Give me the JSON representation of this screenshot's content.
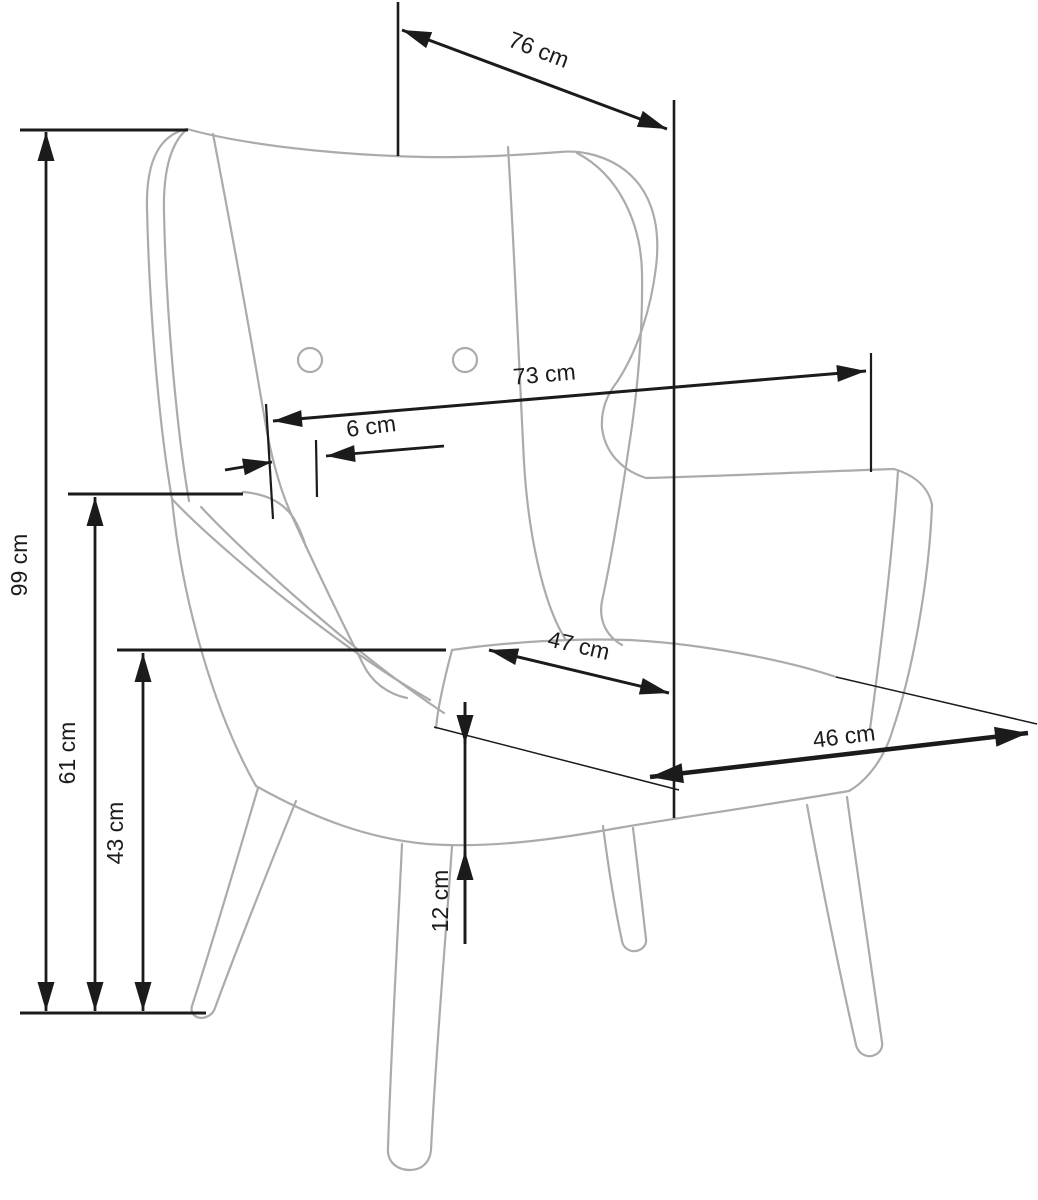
{
  "drawing": {
    "subject": "wingback armchair dimension drawing",
    "unit": "cm",
    "background_color": "#ffffff",
    "outline_color": "#ababab",
    "dimension_color": "#1b1b1b",
    "button_count": 2
  },
  "dims": {
    "top_depth": {
      "label": "76 cm",
      "value": 76,
      "unit": "cm",
      "orientation": "diagonal"
    },
    "total_depth": {
      "label": "73 cm",
      "value": 73,
      "unit": "cm",
      "orientation": "horizontal"
    },
    "back_offset": {
      "label": "6 cm",
      "value": 6,
      "unit": "cm",
      "orientation": "horizontal"
    },
    "total_height": {
      "label": "99 cm",
      "value": 99,
      "unit": "cm",
      "orientation": "vertical"
    },
    "arm_height": {
      "label": "61 cm",
      "value": 61,
      "unit": "cm",
      "orientation": "vertical"
    },
    "seat_height": {
      "label": "43 cm",
      "value": 43,
      "unit": "cm",
      "orientation": "vertical"
    },
    "seat_depth": {
      "label": "47 cm",
      "value": 47,
      "unit": "cm",
      "orientation": "diagonal"
    },
    "seat_width": {
      "label": "46 cm",
      "value": 46,
      "unit": "cm",
      "orientation": "diagonal"
    },
    "front_edge_height": {
      "label": "12 cm",
      "value": 12,
      "unit": "cm",
      "orientation": "vertical"
    }
  }
}
